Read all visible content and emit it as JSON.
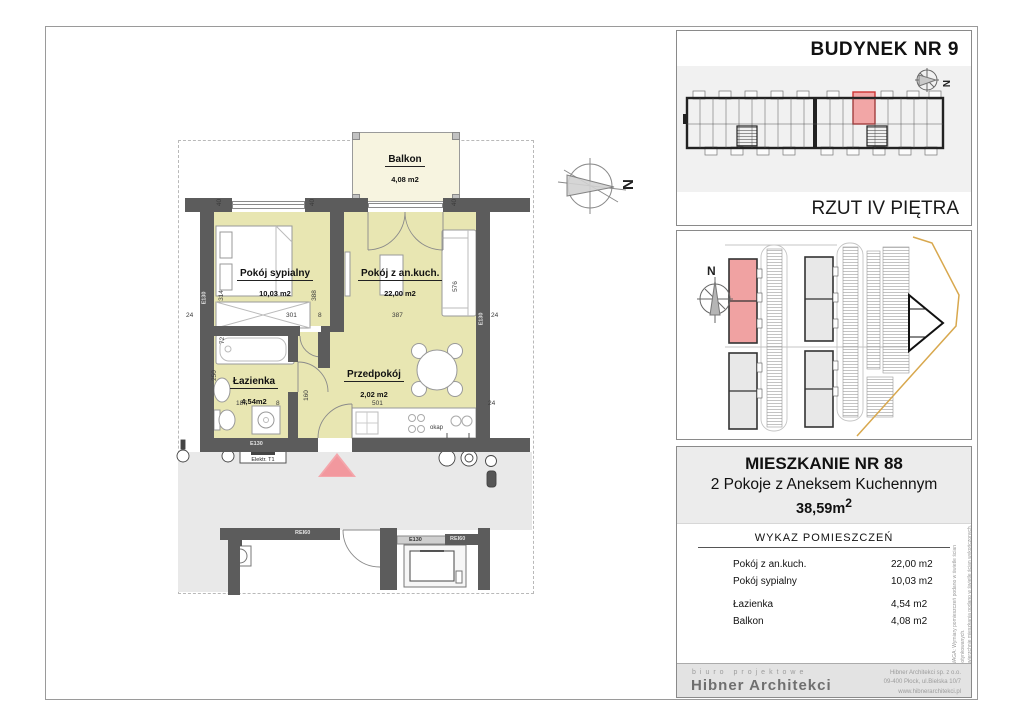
{
  "plan": {
    "balcony": {
      "name": "Balkon",
      "area": "4,08 m2"
    },
    "bedroom": {
      "name": "Pokój sypialny",
      "area": "10,03 m2"
    },
    "living": {
      "name": "Pokój z an.kuch.",
      "area": "22,00 m2"
    },
    "bath": {
      "name": "Łazienka",
      "area": "4,54m2"
    },
    "hall": {
      "name": "Przedpokój",
      "area": "2,02 m2"
    },
    "compass_letter": "N",
    "dims": {
      "a40_1": "40",
      "a40_2": "40",
      "a40_3": "40",
      "w24_left": "24",
      "w301": "301",
      "w8_top": "8",
      "w387": "387",
      "w24_right": "24",
      "h314": "314",
      "h388": "388",
      "h576": "576",
      "h72": "72",
      "h250": "250",
      "w187": "187",
      "w8_bath": "8",
      "w501": "501",
      "h160": "160",
      "w24_low": "24"
    },
    "walls": {
      "e130_left": "E130",
      "e130_right": "E130",
      "e130_bottom": "E130",
      "rei60_corr": "REI60",
      "elev_e130": "E130",
      "elev_rei60": "REI60",
      "elektr": "Elektr. T1",
      "okap": "okap"
    }
  },
  "building_panel": {
    "title": "BUDYNEK NR 9",
    "caption": "RZUT IV PIĘTRA",
    "compass_letter": "N"
  },
  "site_panel": {
    "compass_letter": "N"
  },
  "info_panel": {
    "title": "MIESZKANIE NR 88",
    "subtitle": "2 Pokoje z Aneksem Kuchennym",
    "total_area": "38,59m",
    "total_area_sup": "2",
    "list_title": "WYKAZ POMIESZCZEŃ",
    "rooms": [
      {
        "name": "Pokój z an.kuch.",
        "area": "22,00 m2"
      },
      {
        "name": "Pokój sypialny",
        "area": "10,03 m2"
      },
      {
        "name": "Łazienka",
        "area": "4,54 m2"
      },
      {
        "name": "Balkon",
        "area": "4,08 m2"
      }
    ],
    "disclaimer_line1": "UWAGA: Wymiary pomieszczeń podano w świetle ścian nieotynkowanych.",
    "disclaimer_line2": "Powierzchnię mieszkania podano w świetle ścian wykończonych."
  },
  "footer": {
    "tagline": "biuro projektowe",
    "company": "Hibner Architekci",
    "address1": "Hibner Architekci sp. z o.o.",
    "address2": "09-400 Płock, ul.Bielska 10/7",
    "address3": "www.hibnerarchitekci.pl"
  },
  "colors": {
    "room_fill": "#e8e6b2",
    "balcony_fill": "#f7f4e0",
    "wall": "#5c5c5c",
    "highlight": "#f2a6a6",
    "highlight_border": "#cc3333",
    "boundary_orange": "#d8a84e",
    "corridor": "#e9e9e9"
  }
}
